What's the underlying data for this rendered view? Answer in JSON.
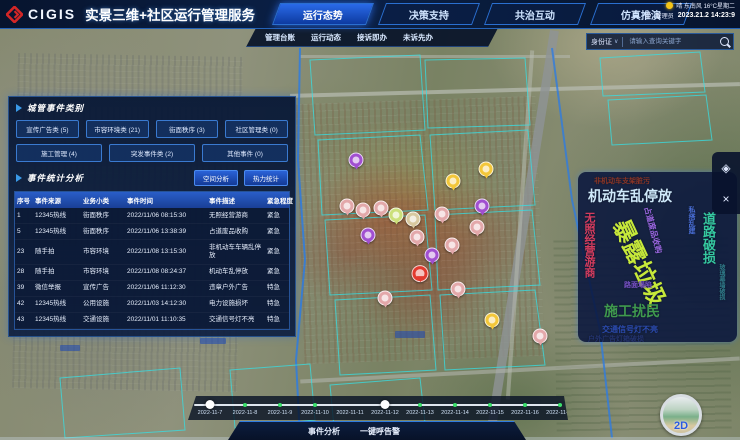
{
  "header": {
    "logo_text": "CIGIS",
    "app_title": "实景三维+社区运行管理服务",
    "weather": "晴 东南风 16°C星期二",
    "user_label": "管理员",
    "datetime": "2023.21.2 14:23:9",
    "tabs": [
      {
        "label": "运行态势",
        "name": "tab-operation-status",
        "active": true
      },
      {
        "label": "决策支持",
        "name": "tab-decision-support",
        "active": false
      },
      {
        "label": "共治互动",
        "name": "tab-co-governance",
        "active": false
      },
      {
        "label": "仿真推演",
        "name": "tab-simulation",
        "active": false
      }
    ],
    "sub_tabs": [
      {
        "label": "管理台账",
        "name": "subtab-management-ledger"
      },
      {
        "label": "运行动态",
        "name": "subtab-operation-dynamics"
      },
      {
        "label": "接诉即办",
        "name": "subtab-complaint-handling"
      },
      {
        "label": "未诉先办",
        "name": "subtab-proactive-service"
      }
    ]
  },
  "search": {
    "type_label": "身份证",
    "placeholder": "请输入查询关键字"
  },
  "left_panel": {
    "section1_title": "城管事件类别",
    "category_rows": [
      [
        "宣传广告类 (5)",
        "市容环境类 (21)",
        "街面秩序 (3)",
        "社区管理类 (0)"
      ],
      [
        "施工管理 (4)",
        "突发事件类 (2)",
        "其他事件 (0)"
      ]
    ],
    "section2_title": "事件统计分析",
    "action_buttons": [
      "空间分析",
      "热力统计"
    ],
    "table": {
      "headers": [
        "序号",
        "事件来源",
        "业务小类",
        "事件时间",
        "事件描述",
        "紧急程度"
      ],
      "rows": [
        [
          "1",
          "12345热线",
          "街面秩序",
          "2022/11/06 08:15:30",
          "无照经营游商",
          "紧急"
        ],
        [
          "5",
          "12345热线",
          "街面秩序",
          "2022/11/06 13:38:39",
          "占道废品收购",
          "紧急"
        ],
        [
          "23",
          "随手拍",
          "市容环境",
          "2022/11/08 13:15:30",
          "非机动车车辆乱停放",
          "紧急"
        ],
        [
          "28",
          "随手拍",
          "市容环境",
          "2022/11/08 08:24:37",
          "机动车乱停放",
          "紧急"
        ],
        [
          "39",
          "微信举报",
          "宣传广告",
          "2022/11/06 11:12:30",
          "违章户外广告",
          "特急"
        ],
        [
          "42",
          "12345热线",
          "公用设施",
          "2022/11/03 14:12:30",
          "电力设施损坏",
          "特急"
        ],
        [
          "43",
          "12345热线",
          "交通设施",
          "2022/11/01 11:10:35",
          "交通信号灯不亮",
          "特急"
        ]
      ]
    }
  },
  "word_cloud": {
    "items": [
      {
        "t": "非机动车支架脏污",
        "x": 16,
        "y": 6,
        "s": 7,
        "c": "#8a3526"
      },
      {
        "t": "机动车乱停放",
        "x": 10,
        "y": 17,
        "s": 14,
        "c": "#cfe9fa"
      },
      {
        "t": "无照经营游商",
        "x": 5,
        "y": 40,
        "s": 11,
        "c": "#d63c5e",
        "v": 1
      },
      {
        "t": "占道废品收购",
        "x": 72,
        "y": 34,
        "s": 8,
        "c": "#9a66e0",
        "r": 75
      },
      {
        "t": "私搭乱建",
        "x": 110,
        "y": 34,
        "s": 7,
        "c": "#4a6fd8",
        "v": 1
      },
      {
        "t": "暴露垃圾",
        "x": 52,
        "y": 44,
        "s": 23,
        "c": "#c6e83a",
        "r": 65
      },
      {
        "t": "道路破损",
        "x": 124,
        "y": 40,
        "s": 13,
        "c": "#35c9a0",
        "v": 1
      },
      {
        "t": "路面塌陷",
        "x": 46,
        "y": 110,
        "s": 7,
        "c": "#7a52c8"
      },
      {
        "t": "玻璃幕墙破损",
        "x": 140,
        "y": 92,
        "s": 6,
        "c": "#2f7a88",
        "v": 1
      },
      {
        "t": "施工扰民",
        "x": 26,
        "y": 132,
        "s": 14,
        "c": "#3f9a4e"
      },
      {
        "t": "交通信号灯不亮",
        "x": 24,
        "y": 154,
        "s": 8,
        "c": "#2b4bb0"
      },
      {
        "t": "户外广告灯箱破损",
        "x": 10,
        "y": 164,
        "s": 7,
        "c": "#23336e"
      }
    ]
  },
  "timeline": {
    "dates": [
      "2022-11-7",
      "2022-11-8",
      "2022-11-9",
      "2022-11-10",
      "2022-11-11",
      "2022-11-12",
      "2022-11-13",
      "2022-11-14",
      "2022-11-15",
      "2022-11-16",
      "2022-11-17"
    ],
    "tick_indices": [
      1,
      2,
      3,
      6,
      7,
      8,
      9,
      10
    ],
    "handle_indices": [
      0,
      5
    ]
  },
  "bottom_bar": {
    "buttons": [
      "事件分析",
      "一键呼告警"
    ]
  },
  "toolbar": {
    "icons": [
      {
        "name": "layers-icon",
        "glyph": "◈"
      },
      {
        "name": "map-tools-icon",
        "glyph": "×"
      }
    ]
  },
  "map": {
    "compass_label": "2D",
    "markers": [
      {
        "x": 356,
        "y": 163,
        "c": "#a14fd0"
      },
      {
        "x": 453,
        "y": 184,
        "c": "#f3c73a"
      },
      {
        "x": 486,
        "y": 172,
        "c": "#f3c73a"
      },
      {
        "x": 347,
        "y": 209,
        "c": "#e3a8aa"
      },
      {
        "x": 363,
        "y": 213,
        "c": "#e3a8aa"
      },
      {
        "x": 381,
        "y": 211,
        "c": "#e3a8aa"
      },
      {
        "x": 396,
        "y": 218,
        "c": "#cbe07a"
      },
      {
        "x": 413,
        "y": 222,
        "c": "#d8c9a0"
      },
      {
        "x": 442,
        "y": 217,
        "c": "#e3a8aa"
      },
      {
        "x": 482,
        "y": 209,
        "c": "#a14fd0"
      },
      {
        "x": 477,
        "y": 230,
        "c": "#e3a8aa"
      },
      {
        "x": 368,
        "y": 238,
        "c": "#a14fd0"
      },
      {
        "x": 417,
        "y": 240,
        "c": "#e3a8aa"
      },
      {
        "x": 452,
        "y": 248,
        "c": "#e3a8aa"
      },
      {
        "x": 432,
        "y": 258,
        "c": "#a14fd0"
      },
      {
        "x": 420,
        "y": 277,
        "c": "#e23a2e",
        "big": 1
      },
      {
        "x": 458,
        "y": 292,
        "c": "#e3a8aa"
      },
      {
        "x": 385,
        "y": 301,
        "c": "#e3a8aa"
      },
      {
        "x": 492,
        "y": 323,
        "c": "#f3c73a"
      },
      {
        "x": 540,
        "y": 339,
        "c": "#e3a8aa"
      }
    ]
  }
}
